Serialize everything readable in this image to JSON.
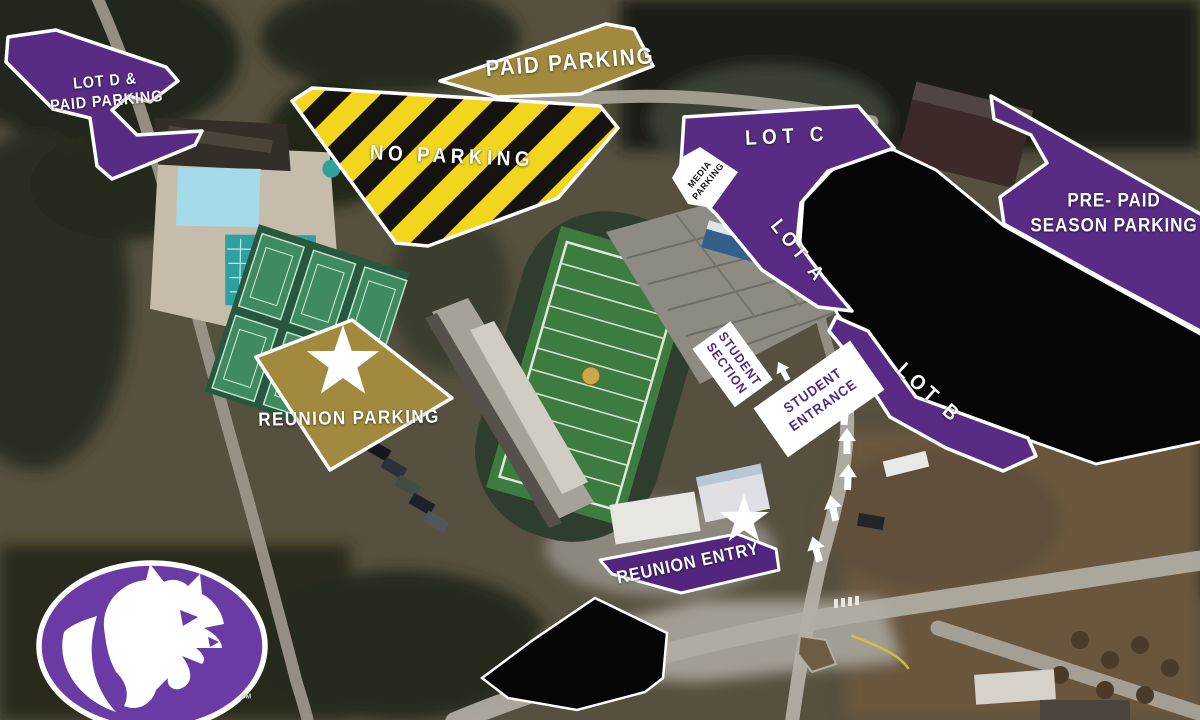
{
  "colors": {
    "zone_purple": "#582c85",
    "entry_purple": "#52267e",
    "zone_gold": "#a18a3e",
    "hazard_yellow": "#f2d51d",
    "hazard_black": "#161310",
    "blackout": "#050505",
    "outline_white": "#ffffff",
    "logo_purple": "#6a3aa5"
  },
  "labels": {
    "lot_d": {
      "line1": "LOT D &",
      "line2": "PAID PARKING"
    },
    "paid_parking": "PAID PARKING",
    "no_parking": "NO PARKING",
    "lot_c": "LOT C",
    "media_parking": {
      "line1": "MEDIA",
      "line2": "PARKING"
    },
    "pre_paid_season": {
      "line1": "PRE- PAID",
      "line2": "SEASON PARKING"
    },
    "lot_a": "LOT A",
    "lot_b": "LOT B",
    "student_section": {
      "line1": "STUDENT",
      "line2": "SECTION"
    },
    "student_entrance": {
      "line1": "STUDENT",
      "line2": "ENTRANCE"
    },
    "reunion_parking": "REUNION PARKING",
    "reunion_entry": "REUNION ENTRY",
    "logo_trademark": "SM"
  }
}
